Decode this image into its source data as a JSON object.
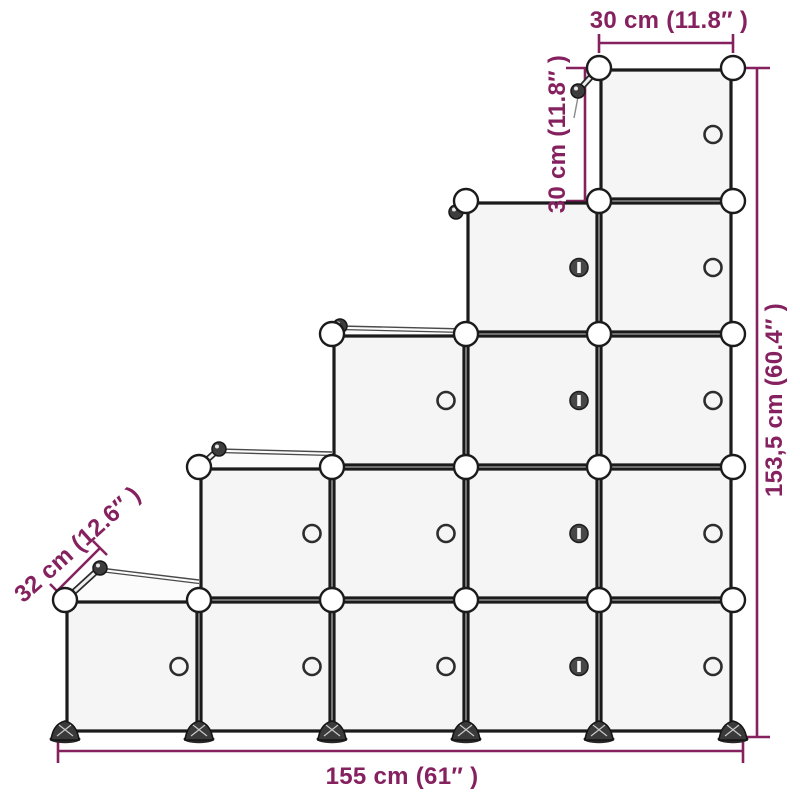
{
  "diagram": {
    "type": "product-dimension-diagram",
    "subject": "staircase cube storage organizer with doors"
  },
  "colors": {
    "dimension": "#86215f",
    "line": "#1b1b1b",
    "face": "#f5f5f5",
    "ball": "#ffffff",
    "foot": "#3a3a3a",
    "background": "#ffffff"
  },
  "structure": {
    "columns_cubes": [
      1,
      2,
      3,
      4,
      5
    ],
    "total_cubes": 15,
    "latch_knob_column": 4,
    "cube_size_cm": 30
  },
  "dimensions": {
    "top_width": {
      "label": "30 cm (11.8″ )"
    },
    "cube_height": {
      "label": "30 cm (11.8″ )"
    },
    "total_height": {
      "label": "153,5 cm (60.4″ )"
    },
    "total_width": {
      "label": "155 cm (61″ )"
    },
    "depth": {
      "label": "32 cm (12.6″ )"
    }
  }
}
